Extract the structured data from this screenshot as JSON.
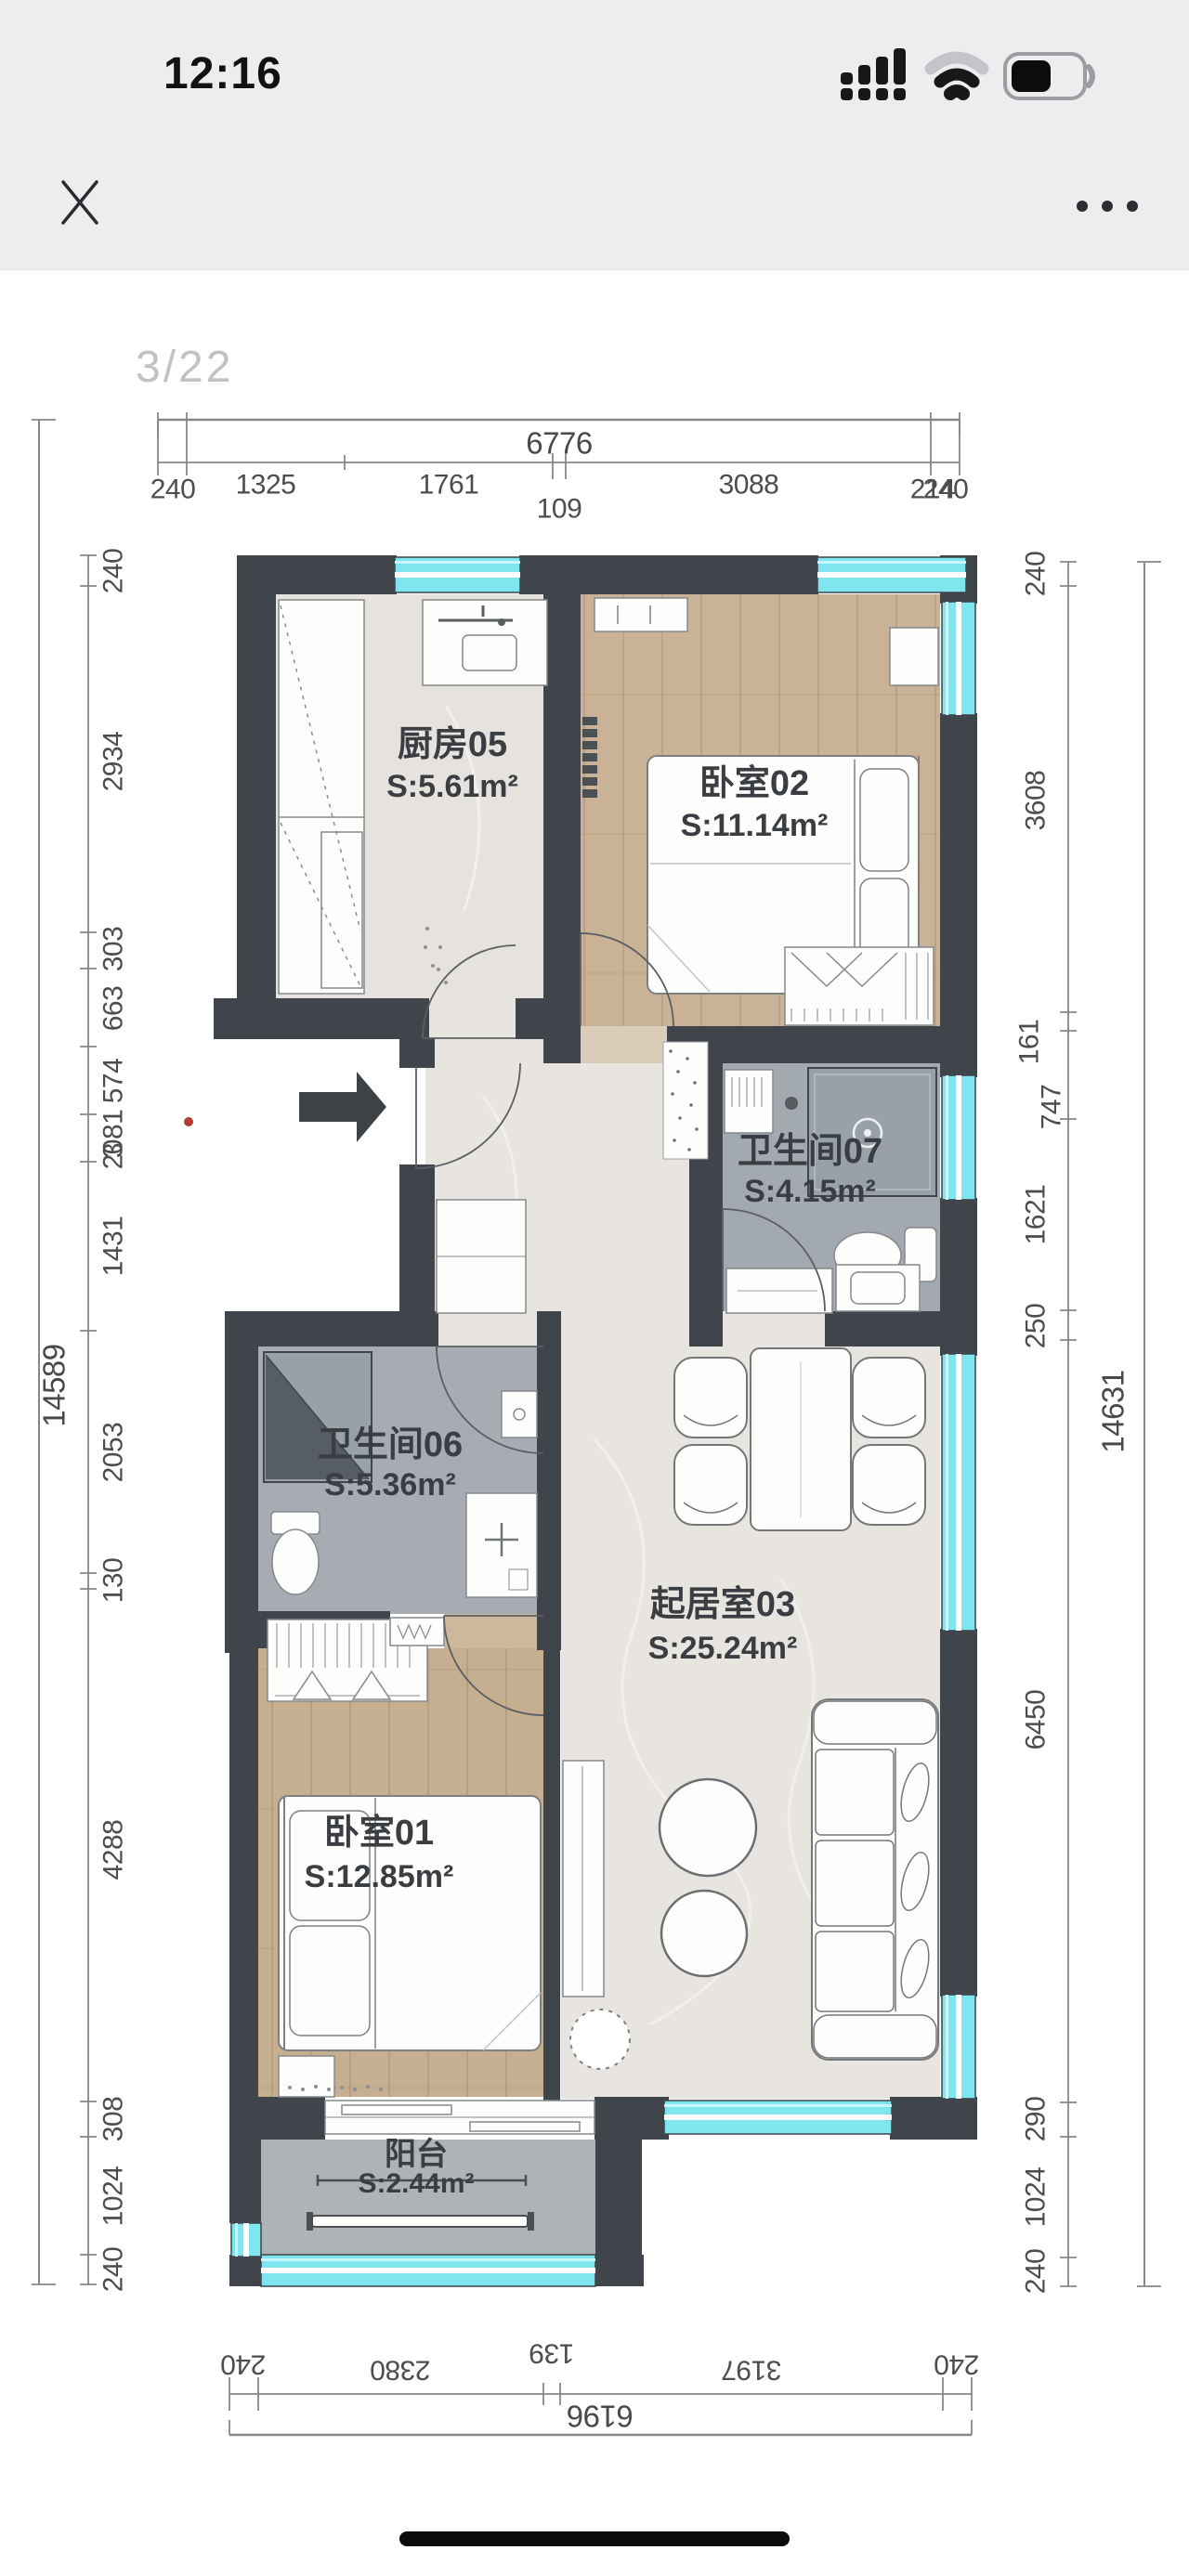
{
  "status_bar": {
    "time": "12:16"
  },
  "viewer": {
    "page_indicator": "3/22"
  },
  "floor_plan": {
    "rooms": [
      {
        "id": "kitchen",
        "name": "厨房05",
        "area": "S:5.61m²"
      },
      {
        "id": "bedroom2",
        "name": "卧室02",
        "area": "S:11.14m²"
      },
      {
        "id": "bathroom7",
        "name": "卫生间07",
        "area": "S:4.15m²"
      },
      {
        "id": "bathroom6",
        "name": "卫生间06",
        "area": "S:5.36m²"
      },
      {
        "id": "living",
        "name": "起居室03",
        "area": "S:25.24m²"
      },
      {
        "id": "bedroom1",
        "name": "卧室01",
        "area": "S:12.85m²"
      },
      {
        "id": "balcony",
        "name": "阳台",
        "area": "S:2.44m²"
      }
    ],
    "dimensions": {
      "top": {
        "total": "6776",
        "segments": [
          "240",
          "1325",
          "1761",
          "109",
          "3088",
          "240"
        ],
        "overlap_label": "214"
      },
      "left": {
        "total": "14589",
        "segments": [
          "240",
          "2934",
          "303",
          "663",
          "574",
          "2081",
          "1431",
          "2053",
          "130",
          "4288",
          "308",
          "1024",
          "240"
        ],
        "overlap_label": "3"
      },
      "right": {
        "total": "14631",
        "segments": [
          "240",
          "3608",
          "161",
          "747",
          "1621",
          "250",
          "6450",
          "290",
          "1024",
          "240"
        ]
      },
      "bottom": {
        "total": "6196",
        "segments": [
          "240",
          "2380",
          "139",
          "3197",
          "240"
        ]
      }
    },
    "colors": {
      "wall": "#3f454a",
      "window": "#7fe6ef",
      "window_stripe": "#ffffff",
      "wood": "#c9b295",
      "marble": "#e8e5e1",
      "bath_tile": "#a2a9b0",
      "balcony_tile": "#b0b3b5",
      "dim_text": "#4b4d51",
      "red_dot": "#b23b33"
    }
  }
}
